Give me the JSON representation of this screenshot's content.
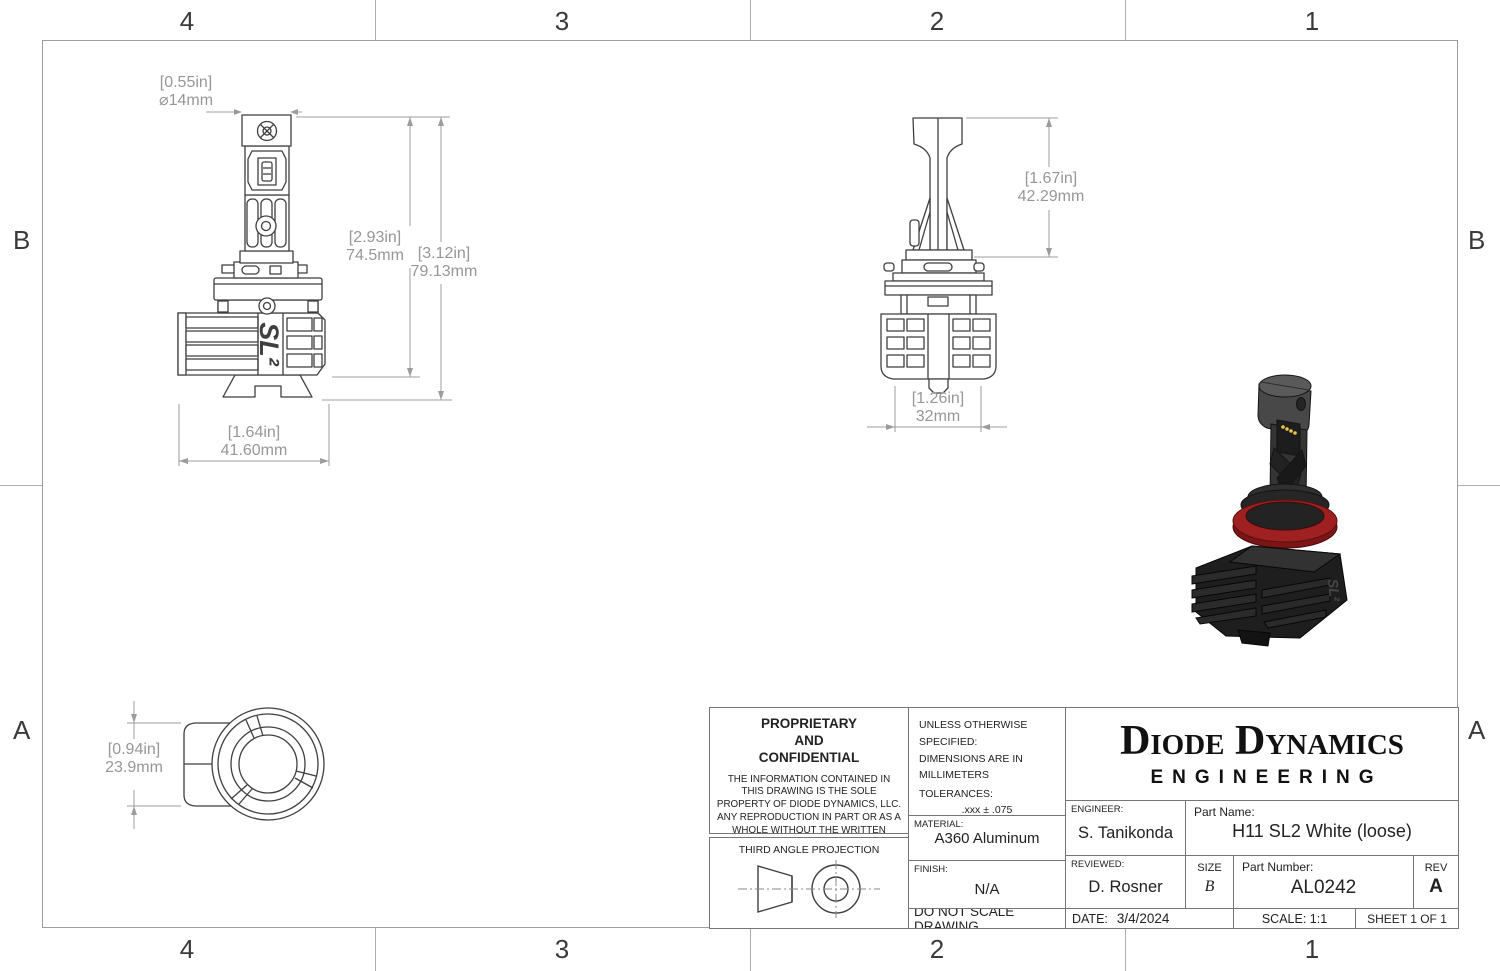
{
  "colors": {
    "accent_red": "#9e2020",
    "part_line": "#3f3f3f",
    "dim_text": "#979797"
  },
  "zones": {
    "top": [
      "4",
      "3",
      "2",
      "1"
    ],
    "bottom": [
      "4",
      "3",
      "2",
      "1"
    ],
    "left": [
      "B",
      "A"
    ],
    "right": [
      "B",
      "A"
    ]
  },
  "part_logo": "SL²",
  "dimensions": {
    "front_diameter": {
      "in": "[0.55in]",
      "mm": "⌀14mm"
    },
    "front_body_height": {
      "in": "[2.93in]",
      "mm": "74.5mm"
    },
    "front_total_height": {
      "in": "[3.12in]",
      "mm": "79.13mm"
    },
    "front_width": {
      "in": "[1.64in]",
      "mm": "41.60mm"
    },
    "side_upper_height": {
      "in": "[1.67in]",
      "mm": "42.29mm"
    },
    "side_width": {
      "in": "[1.26in]",
      "mm": "32mm"
    },
    "bottom_height": {
      "in": "[0.94in]",
      "mm": "23.9mm"
    }
  },
  "title_block": {
    "proprietary_title": "PROPRIETARY\nAND\nCONFIDENTIAL",
    "proprietary_body": "THE INFORMATION CONTAINED IN THIS DRAWING IS THE SOLE PROPERTY OF DIODE DYNAMICS, LLC.  ANY REPRODUCTION IN PART OR AS A WHOLE WITHOUT THE WRITTEN PERMISSION OF DIODE DYNAMICS, LLC. IS PROHIBITED.",
    "third_angle": "THIRD ANGLE PROJECTION",
    "spec_line1": "UNLESS OTHERWISE SPECIFIED:",
    "spec_line2": "DIMENSIONS ARE IN MILLIMETERS",
    "tolerances_label": "TOLERANCES:",
    "tolerances": [
      ".xxx ± .075",
      ".xx ± .15",
      ".x ± .3",
      "x ± .5",
      "ANG ± 1"
    ],
    "material_label": "MATERIAL:",
    "material_value": "A360 Aluminum",
    "finish_label": "FINISH:",
    "finish_value": "N/A",
    "do_not_scale": "DO NOT SCALE DRAWING",
    "logo_name": "Diode Dynamics",
    "logo_sub": "ENGINEERING",
    "engineer_label": "ENGINEER:",
    "engineer_value": "S. Tanikonda",
    "reviewed_label": "REVIEWED:",
    "reviewed_value": "D. Rosner",
    "date_label": "DATE:",
    "date_value": "3/4/2024",
    "part_name_label": "Part Name:",
    "part_name_value": "H11 SL2 White (loose)",
    "size_label": "SIZE",
    "size_value": "B",
    "part_number_label": "Part Number:",
    "part_number_value": "AL0242",
    "rev_label": "REV",
    "rev_value": "A",
    "scale_text": "SCALE: 1:1",
    "sheet_text": "SHEET 1 OF 1"
  }
}
